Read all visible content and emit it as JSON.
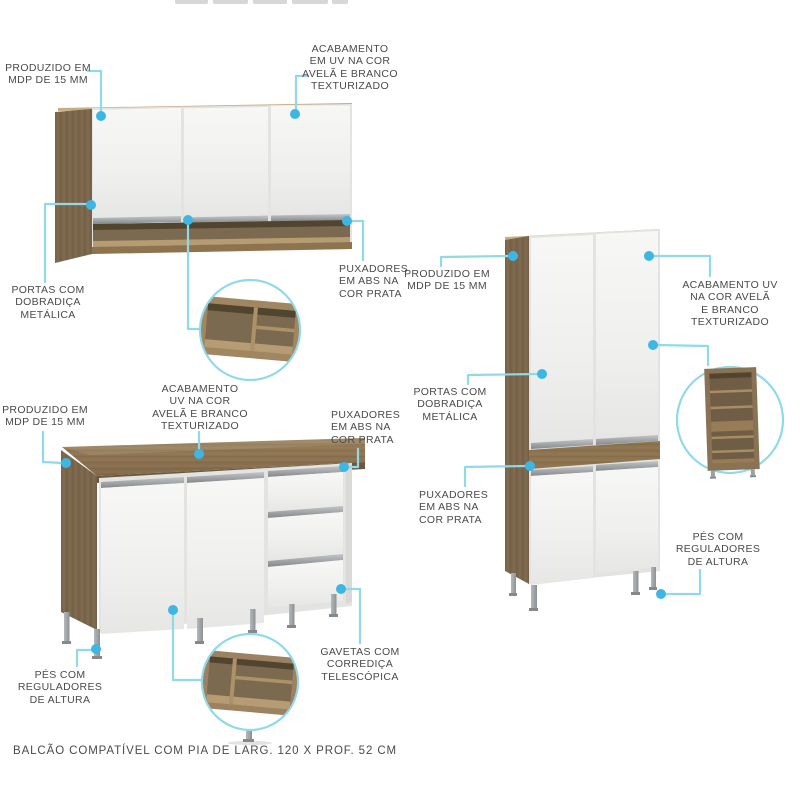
{
  "caption": "BALCÃO COMPATÍVEL COM PIA DE LARG. 120 X PROF. 52 CM",
  "callouts": {
    "wall_cabinet": {
      "produced": "PRODUZIDO EM\nMDP DE 15 MM",
      "finish": "ACABAMENTO\nEM UV NA COR\nAVELÃ E BRANCO\nTEXTURIZADO",
      "doors": "PORTAS COM\nDOBRADIÇA\nMETÁLICA",
      "handles": "PUXADORES\nEM ABS NA\nCOR PRATA"
    },
    "base_cabinet": {
      "produced": "PRODUZIDO EM\nMDP DE 15 MM",
      "finish": "ACABAMENTO\nUV NA COR\nAVELÃ E BRANCO\nTEXTURIZADO",
      "handles": "PUXADORES\nEM ABS NA\nCOR PRATA",
      "feet": "PÉS COM\nREGULADORES\nDE ALTURA",
      "drawers": "GAVETAS COM\nCORREDIÇA\nTELESCÓPICA"
    },
    "tall_cabinet": {
      "produced": "PRODUZIDO EM\nMDP DE 15 MM",
      "finish": "ACABAMENTO UV\nNA COR AVELÃ\nE BRANCO\nTEXTURIZADO",
      "doors": "PORTAS COM\nDOBRADIÇA\nMETÁLICA",
      "handles": "PUXADORES\nEM ABS NA\nCOR PRATA",
      "feet": "PÉS COM\nREGULADORES\nDE ALTURA"
    }
  },
  "colors": {
    "accent_dot": "#3db6e4",
    "leader_line": "#8fd9e9",
    "wood": "#8d744f",
    "wood_dark": "#7b664b",
    "wood_edge": "#6b583f",
    "wood_light": "#b59c72",
    "door_white": "#f2f2f0",
    "handle_silver": "#a4a8ab",
    "leg_silver": "#a9acae",
    "text": "#4a4a4a"
  }
}
